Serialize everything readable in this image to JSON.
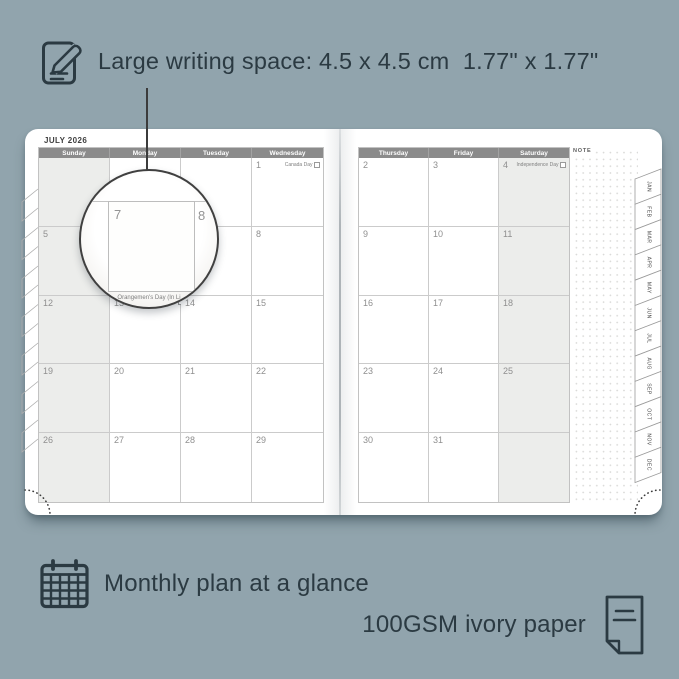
{
  "colors": {
    "background": "#91a4ad",
    "ink": "#2b3a42",
    "header_bg": "#8b8b8b",
    "weekend_bg": "#ecedeb",
    "grid_line": "#cbcbcb",
    "date_text": "#8f8f8f"
  },
  "annotations": {
    "top": {
      "icon": "note-pencil-icon",
      "text": "Large writing space: 4.5 x 4.5 cm  1.77\" x 1.77\""
    },
    "bottom_left": {
      "icon": "calendar-grid-icon",
      "text": "Monthly plan at a glance"
    },
    "bottom_right": {
      "icon": "paper-sheet-icon",
      "text": "100GSM ivory paper"
    }
  },
  "planner": {
    "month_title": "JULY 2026",
    "note_label": "NOTE",
    "left_page": {
      "day_headers": [
        "Sunday",
        "Monday",
        "Tuesday",
        "Wednesday"
      ],
      "weekend_col": 0,
      "rows": [
        [
          "",
          "",
          "",
          {
            "date": "1",
            "holiday": "Canada Day"
          }
        ],
        [
          "5",
          "6",
          "7",
          "8"
        ],
        [
          "12",
          {
            "date": "13",
            "holiday": "Orangemen's Day (In Li"
          },
          "14",
          "15"
        ],
        [
          "19",
          "20",
          "21",
          "22"
        ],
        [
          "26",
          "27",
          "28",
          "29"
        ]
      ]
    },
    "right_page": {
      "day_headers": [
        "Thursday",
        "Friday",
        "Saturday"
      ],
      "weekend_col": 2,
      "rows": [
        [
          "2",
          "3",
          {
            "date": "4",
            "holiday": "Independence Day"
          }
        ],
        [
          "9",
          "10",
          "11"
        ],
        [
          "16",
          "17",
          "18"
        ],
        [
          "23",
          "24",
          "25"
        ],
        [
          "30",
          "31",
          ""
        ]
      ]
    },
    "month_tabs": [
      "JAN",
      "FEB",
      "MAR",
      "APR",
      "MAY",
      "JUN",
      "JUL",
      "AUG",
      "SEP",
      "OCT",
      "NOV",
      "DEC"
    ],
    "magnifier": {
      "left_date": "7",
      "right_date": "8",
      "caption": "Orangemen's Day (In Li"
    }
  }
}
